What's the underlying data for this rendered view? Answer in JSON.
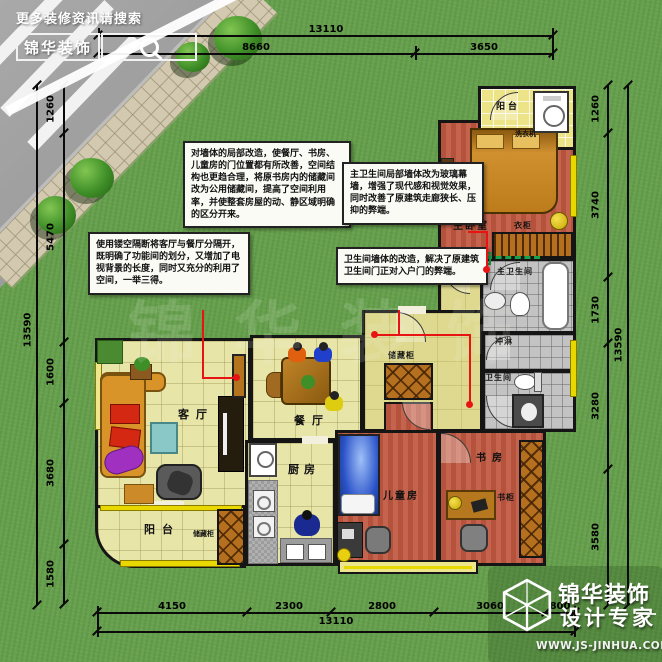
{
  "header": {
    "promo_text": "更多装修资讯请搜索",
    "brand": "锦华装饰"
  },
  "watermark": "锦华装饰",
  "dims": {
    "top": {
      "overall": "13110",
      "segments": [
        "8660",
        "3650"
      ]
    },
    "bottom": {
      "overall": "13110",
      "segments": [
        "4150",
        "2300",
        "2800",
        "3060",
        "800"
      ]
    },
    "left": {
      "overall": "13590",
      "segments": [
        "1260",
        "5470",
        "1600",
        "3680",
        "1580"
      ]
    },
    "right": {
      "overall": "13590",
      "segments": [
        "1260",
        "3740",
        "1730",
        "3280",
        "3580"
      ]
    }
  },
  "rooms": [
    {
      "label": "阳台"
    },
    {
      "label": "洗衣机"
    },
    {
      "label": "主卧室"
    },
    {
      "label": "衣柜"
    },
    {
      "label": "主卫生间"
    },
    {
      "label": "冲淋"
    },
    {
      "label": "卫生间"
    },
    {
      "label": "储藏柜"
    },
    {
      "label": "客厅"
    },
    {
      "label": "餐厅"
    },
    {
      "label": "厨房"
    },
    {
      "label": "儿童房"
    },
    {
      "label": "书房"
    },
    {
      "label": "书柜"
    },
    {
      "label": "阳台"
    },
    {
      "label": "储藏柜"
    }
  ],
  "annotations": [
    {
      "text": "对墙体的局部改造，使餐厅、书房、儿童房的门位置都有所改善，空间结构也更趋合理，将原书房内的储藏间改为公用储藏间，提高了空间利用率，并使整套房屋的动、静区域明确的区分开来。"
    },
    {
      "text": "使用镂空隔断将客厅与餐厅分隔开，既明确了功能间的划分，又增加了电视背景的长度，同时又充分的利用了空间，一举三得。"
    },
    {
      "text": "主卫生间局部墙体改为玻璃幕墙，增强了现代感和视觉效果，同时改善了原建筑走廊狭长、压抑的弊端。"
    },
    {
      "text": "卫生间墙体的改造，解决了原建筑卫生间门正对入户门的弊端。"
    }
  ],
  "footer": {
    "brand": "锦华装饰",
    "tagline": "设计专家",
    "website": "WWW.JS-JINHUA.COM"
  },
  "colors": {
    "grass": "#67a04e",
    "wall": "#151515",
    "annotation_line_red": "#e81313",
    "glass_wall_green": "#17a34a",
    "window_yellow": "#e8d800",
    "floor_red": "#b5523c",
    "floor_pale": "#e8e5a8",
    "tile_gray": "#c3c3c3"
  }
}
